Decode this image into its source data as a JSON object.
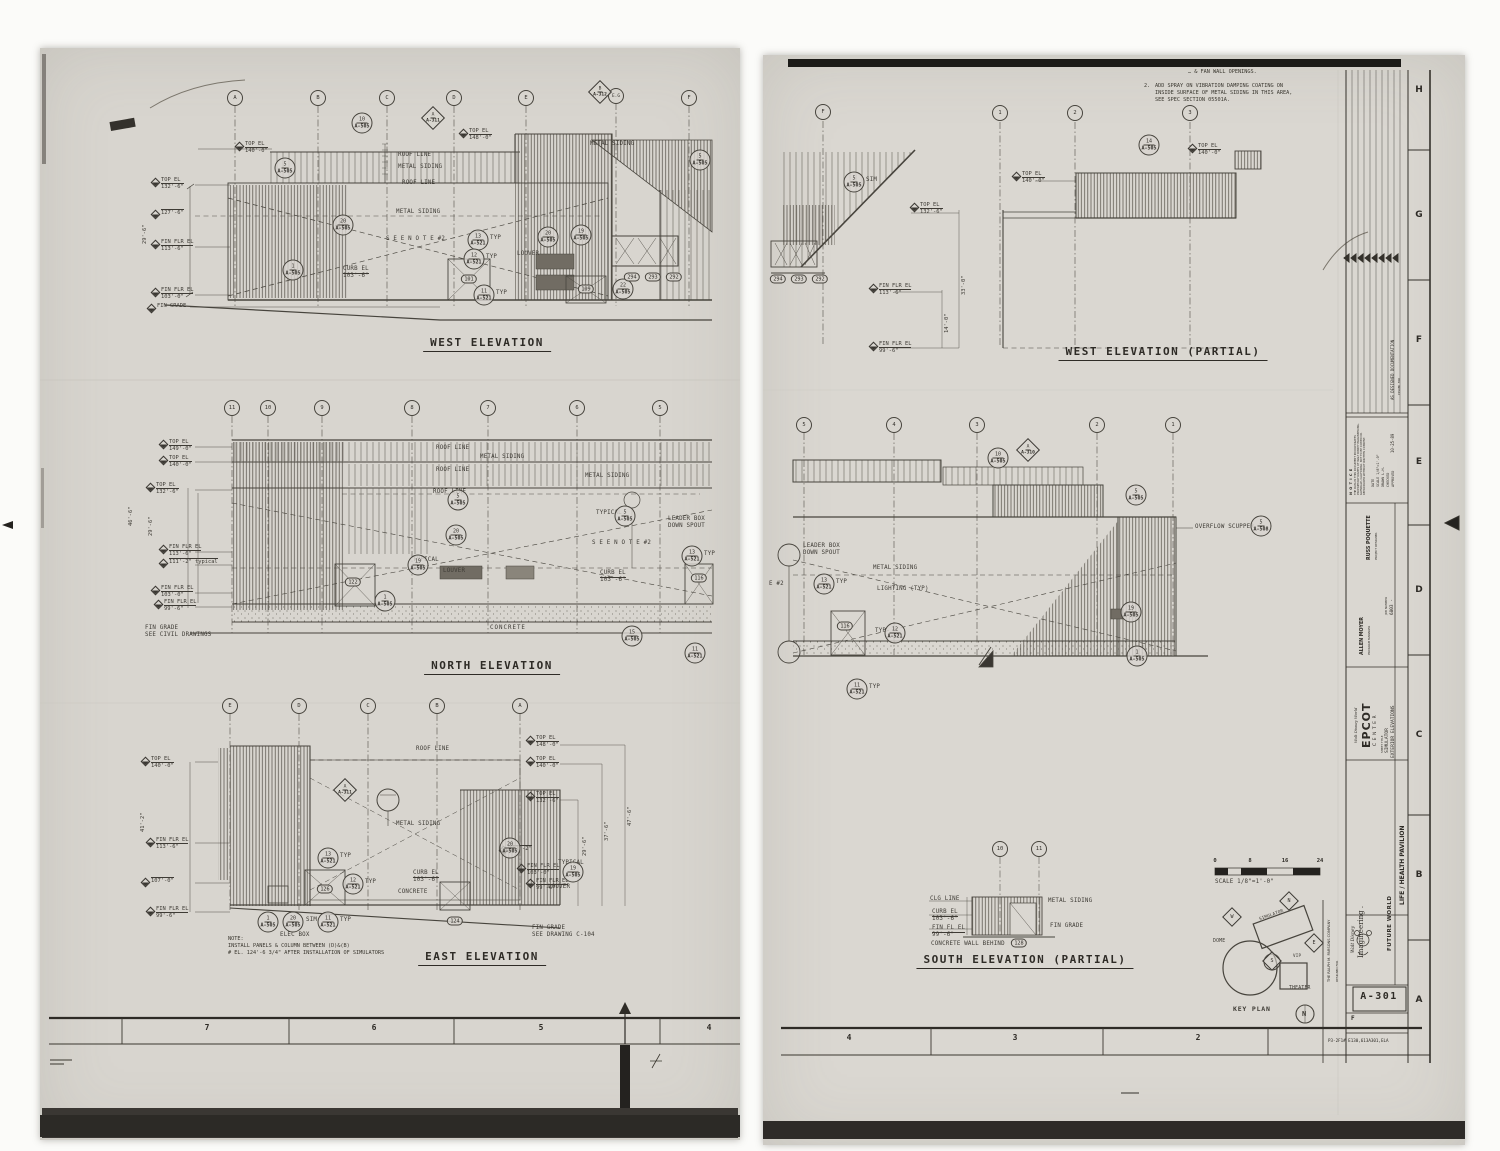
{
  "s1": {
    "border_cells": [
      "7",
      "6",
      "5",
      "4"
    ],
    "west": {
      "title": "WEST ELEVATION",
      "grid": [
        "A",
        "B",
        "C",
        "D",
        "E",
        "E.G",
        "F"
      ],
      "diam_b": {
        "n": "B",
        "r": "A-312"
      },
      "diam_a": {
        "n": "A",
        "r": "A-311"
      },
      "elev": [
        [
          "TOP EL",
          "140'-0\""
        ],
        [
          "TOP EL",
          "132'-6\""
        ],
        [
          "",
          "127'-6\""
        ],
        [
          "FIN FLR EL",
          "113'-6\""
        ],
        [
          "FIN FLR EL",
          "103'-0\""
        ],
        [
          "FIN GRADE",
          ""
        ],
        [
          "TOP EL",
          "148'-0\""
        ]
      ],
      "dim": "29'-6\"",
      "labels": {
        "roof1": "ROOF LINE",
        "ms1": "METAL SIDING",
        "roof2": "ROOF LINE",
        "ms2": "METAL SIDING",
        "see_note": "S E E   N O T E   #2",
        "curb": "CURB EL",
        "curb_v": "103'-6\"",
        "louver": "LOUVER",
        "ms3": "METAL SIDING",
        "typ": "TYP"
      },
      "bubs": [
        [
          "10",
          "A-505"
        ],
        [
          "5",
          "A-505"
        ],
        [
          "20",
          "A-505"
        ],
        [
          "13",
          "A-521"
        ],
        [
          "12",
          "A-521"
        ],
        [
          "11",
          "A-521"
        ],
        [
          "1",
          "A-505"
        ],
        [
          "20",
          "A-505"
        ],
        [
          "19",
          "A-505"
        ],
        [
          "22",
          "A-505"
        ],
        [
          "5",
          "A-505"
        ]
      ],
      "tags": [
        "101",
        "109",
        "294",
        "293",
        "292"
      ]
    },
    "north": {
      "title": "NORTH ELEVATION",
      "grid": [
        "11",
        "10",
        "9",
        "8",
        "7",
        "6",
        "5"
      ],
      "elev": [
        [
          "TOP EL",
          "149'-0\""
        ],
        [
          "TOP EL",
          "140'-0\""
        ],
        [
          "TOP EL",
          "132'-6\""
        ],
        [
          "FIN FLR EL",
          "113'-6\""
        ],
        [
          "",
          "111'-2\" typical"
        ],
        [
          "FIN FLR EL",
          "103'-0\""
        ],
        [
          "FIN FLR EL",
          "99'-6\""
        ]
      ],
      "fin_grade": [
        "FIN GRADE",
        "SEE CIVIL DRAWINGS"
      ],
      "dims": [
        "46'-6\"",
        "29'-6\""
      ],
      "labels": {
        "roof1": "ROOF LINE",
        "ms1": "METAL SIDING",
        "roof2": "ROOF LINE",
        "ms2": "METAL SIDING",
        "roof3": "ROOF LINE",
        "typical1": "TYPICAL",
        "leader": "LEADER BOX",
        "spout": "DOWN SPOUT",
        "see_note": "S E E   N O T E   #2",
        "typical2": "TYPICAL",
        "curb": "CURB EL",
        "curb_v": "103'-6\"",
        "concrete": "CONCRETE",
        "louver": "LOUVER",
        "typ": "TYP"
      },
      "bubs": [
        [
          "5",
          "A-505"
        ],
        [
          "20",
          "A-505"
        ],
        [
          "19",
          "A-505"
        ],
        [
          "5",
          "A-505"
        ],
        [
          "13",
          "A-521"
        ],
        [
          "1",
          "A-505"
        ],
        [
          "15",
          "A-505"
        ],
        [
          "11",
          "A-521"
        ]
      ],
      "tags": [
        "122",
        "116"
      ]
    },
    "east": {
      "title": "EAST ELEVATION",
      "grid": [
        "E",
        "D",
        "C",
        "B",
        "A"
      ],
      "diam_a": {
        "n": "A",
        "r": "A-311"
      },
      "elev_left": [
        [
          "TOP EL",
          "140'-0\""
        ],
        [
          "FIN FLR EL",
          "113'-6\""
        ],
        [
          "",
          "107'-0\""
        ],
        [
          "FIN FLR EL",
          "99'-6\""
        ]
      ],
      "elev_right": [
        [
          "TOP EL",
          "148'-0\""
        ],
        [
          "TOP EL",
          "140'-0\""
        ],
        [
          "TOP EL",
          "132'-6\""
        ],
        [
          "",
          "111'-2\""
        ],
        [
          "FIN FLR EL",
          "103'-0\""
        ],
        [
          "FIN FLR EL",
          "99'-6\""
        ]
      ],
      "dims": [
        "41'-2\"",
        "47'-6\"",
        "37'-6\"",
        "29'-6\""
      ],
      "labels": {
        "roof": "ROOF LINE",
        "ms": "METAL SIDING",
        "curb": "CURB EL",
        "curb_v": "103'-6\"",
        "concrete": "CONCRETE",
        "elec": "ELEC BOX",
        "sim": "SIM",
        "typical": "TYPICAL",
        "louver": "LOUVER",
        "typ": "TYP"
      },
      "fin_grade": [
        "FIN GRADE",
        "SEE DRAWING C-104"
      ],
      "note": [
        "NOTE:",
        "INSTALL PANELS & COLUMN BETWEEN (D)&(B)",
        "# EL. 124'-6 3/4\" AFTER INSTALLATION OF SIMULATORS"
      ],
      "bubs": [
        [
          "13",
          "A-521"
        ],
        [
          "12",
          "A-521"
        ],
        [
          "11",
          "A-521"
        ],
        [
          "1",
          "A-505"
        ],
        [
          "20",
          "A-505"
        ],
        [
          "20",
          "A-505"
        ],
        [
          "19",
          "A-505"
        ]
      ],
      "tags": [
        "126",
        "124"
      ]
    }
  },
  "s2": {
    "border_cells": [
      "4",
      "3",
      "2"
    ],
    "notes": [
      "… & FAN WALL OPENINGS.",
      "2.",
      "ADD SPRAY ON VIBRATION DAMPING COATING ON",
      "INSIDE SURFACE OF METAL SIDING IN THIS AREA,",
      "SEE SPEC SECTION 05501A."
    ],
    "west_partial": {
      "title": "WEST ELEVATION (PARTIAL)",
      "grid": [
        "F",
        "1",
        "2",
        "3"
      ],
      "bub_sim": [
        "5",
        "A-505"
      ],
      "sim": "SIM",
      "bub14": [
        "14",
        "A-505"
      ],
      "elev": [
        [
          "TOP EL",
          "132'-6\""
        ],
        [
          "FIN FLR EL",
          "113'-6\""
        ],
        [
          "FIN FLR EL",
          "99'-6\""
        ],
        [
          "TOP EL",
          "140'-0\""
        ],
        [
          "TOP EL",
          "140'-0\""
        ]
      ],
      "dims": [
        "33'-0\"",
        "14'-0\""
      ],
      "tags": [
        "294",
        "293",
        "292"
      ]
    },
    "south_main": {
      "grid": [
        "5",
        "4",
        "3",
        "2",
        "1"
      ],
      "diam_a": {
        "n": "A",
        "r": "A-310"
      },
      "labels": {
        "leader": "LEADER BOX",
        "spout": "DOWN SPOUT",
        "ms": "METAL SIDING",
        "lighting": "LIGHTING (TYP)",
        "scupper": "OVERFLOW SCUPPER",
        "see_note_cut": "E  #2",
        "typ": "TYP"
      },
      "bubs": [
        [
          "10",
          "A-505"
        ],
        [
          "5",
          "A-505"
        ],
        [
          "5",
          "A-508"
        ],
        [
          "13",
          "A-521"
        ],
        [
          "12",
          "A-521"
        ],
        [
          "11",
          "A-521"
        ],
        [
          "19",
          "A-505"
        ],
        [
          "1",
          "A-505"
        ]
      ],
      "tags": [
        "116"
      ]
    },
    "south_partial": {
      "title": "SOUTH ELEVATION (PARTIAL)",
      "grid": [
        "10",
        "11"
      ],
      "labels": {
        "clg": "CLG LINE",
        "curb": "CURB EL",
        "curb_v": "103'-6\"",
        "finfl": "FIN FL EL",
        "finfl_v": "99'-6\"",
        "wall": "CONCRETE WALL BEHIND",
        "ms": "METAL SIDING",
        "grade": "FIN GRADE"
      },
      "tags": [
        "128"
      ]
    },
    "scale_bar": {
      "ticks": [
        "0",
        "8",
        "16",
        "24"
      ],
      "label": "SCALE 1/8\"=1'-0\""
    },
    "key_plan": {
      "title": "KEY PLAN",
      "dome": "DOME",
      "simulator": "SIMULATOR",
      "theater": "THEATER",
      "vip": "VIP",
      "flags": [
        "W",
        "N",
        "E",
        "S"
      ],
      "north": "N"
    }
  },
  "tb": {
    "rows": [
      "H",
      "G",
      "F",
      "E",
      "D",
      "C",
      "B",
      "A"
    ],
    "rev_text": "AS DESIGNED DOCUMENTATION",
    "issued": "ISSUED FOR",
    "rev_date": "10-25-89",
    "notice_head": "N O T I C E",
    "notice_body": "THE DATA IN THIS DOCUMENT INCORPORATES PROPRIETARY RIGHTS OF WALT DISNEY IMAGINEERING, GLENDALE, CALIFORNIA. NOT TO BE COPIED OR REPRODUCED WITHOUT WRITTEN CONSENT.",
    "fields": [
      [
        "DATE",
        ""
      ],
      [
        "SCALE",
        "1/8\"=1'-0\""
      ],
      [
        "DRAWN",
        "L.H."
      ],
      [
        "CHECKED",
        ""
      ],
      [
        "APPROVED",
        ""
      ]
    ],
    "people": [
      [
        "PROJECT DESIGNER",
        "RUSS POQUETTE"
      ],
      [
        "PROGRAM MANAGER",
        "ALLEN MOYER"
      ],
      [
        "JOB NUMBER",
        "6803 -"
      ]
    ],
    "wdw": "Walt Disney World",
    "epcot": "EPCOT",
    "center": "CENTER",
    "sheet_title_label": "SHEET TITLE",
    "sheet_title": [
      "SIMULATOR",
      "EXTERIOR ELEVATIONS"
    ],
    "pavilion": "LIFE / HEALTH PAVILION",
    "wd": "Walt Disney",
    "imagineering": "Imagineering .",
    "area": "FUTURE WORLD",
    "firm": "THE RALPH M. PARSONS COMPANY",
    "designed_for": "DESIGNED FOR",
    "sheet_no": "A-301",
    "rev_letter": "F",
    "microfilm": "P3-2F1# E130,613A301,ELA"
  }
}
